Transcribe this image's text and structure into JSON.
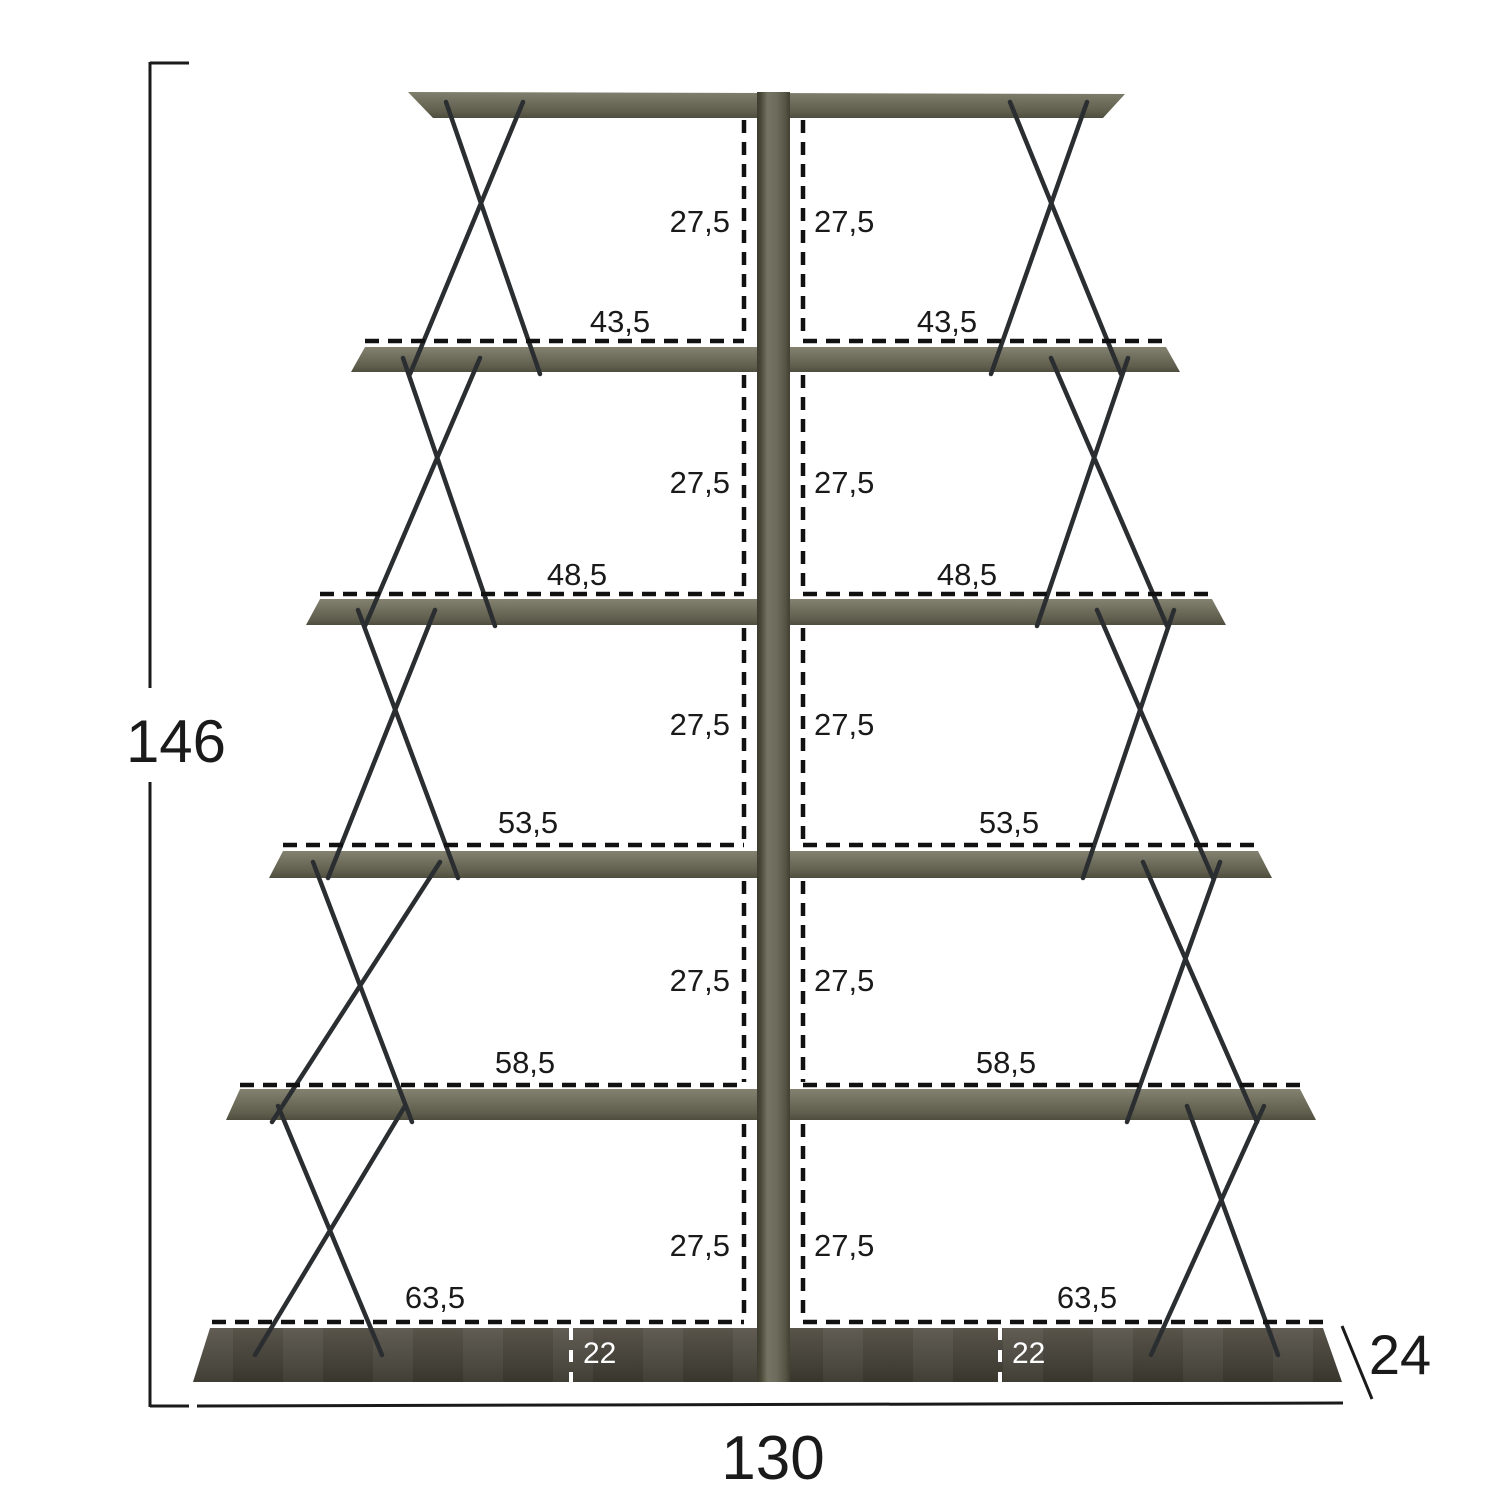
{
  "diagram": {
    "overall": {
      "height": "146",
      "width": "130",
      "depth": "24"
    },
    "gaps": [
      {
        "left": "27,5",
        "right": "27,5"
      },
      {
        "left": "27,5",
        "right": "27,5"
      },
      {
        "left": "27,5",
        "right": "27,5"
      },
      {
        "left": "27,5",
        "right": "27,5"
      },
      {
        "left": "27,5",
        "right": "27,5"
      }
    ],
    "shelf_widths": [
      {
        "left": "43,5",
        "right": "43,5"
      },
      {
        "left": "48,5",
        "right": "48,5"
      },
      {
        "left": "53,5",
        "right": "53,5"
      },
      {
        "left": "58,5",
        "right": "58,5"
      },
      {
        "left": "63,5",
        "right": "63,5"
      }
    ],
    "base_offsets": {
      "left": "22",
      "right": "22"
    }
  },
  "colors": {
    "shelf_wood": "#6e6c5c",
    "bottom_shelf_wood": "#46433a",
    "wire": "#2b2e31",
    "dimension_line": "#1a1a1a",
    "background": "#ffffff"
  }
}
